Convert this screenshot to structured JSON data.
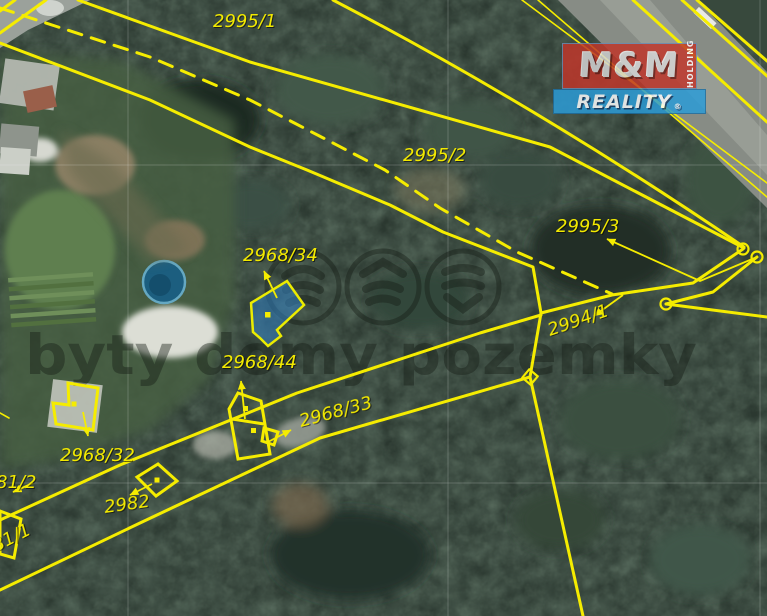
{
  "map": {
    "watermark": {
      "text": "byty domy pozemky"
    },
    "logo": {
      "mm": "M&M",
      "holding": "HOLDING",
      "reality": "REALITY",
      "registered": "®"
    },
    "colors": {
      "line": "#f5ec00",
      "label": "#f2e900",
      "watermark": "rgba(22,28,22,0.42)",
      "highlight_fill": "#2f80c2",
      "logo_red": "#c0362a",
      "logo_blue": "#2b9cd8"
    },
    "parcel_labels": [
      {
        "text": "2995/1",
        "x": 213,
        "y": 27,
        "rot": 0
      },
      {
        "text": "2995/2",
        "x": 403,
        "y": 161,
        "rot": 0
      },
      {
        "text": "2995/3",
        "x": 556,
        "y": 232,
        "rot": 0
      },
      {
        "text": "2994/1",
        "x": 550,
        "y": 336,
        "rot": -19
      },
      {
        "text": "2968/34",
        "x": 243,
        "y": 261,
        "rot": 0
      },
      {
        "text": "2968/44",
        "x": 222,
        "y": 368,
        "rot": 0
      },
      {
        "text": "2968/33",
        "x": 301,
        "y": 427,
        "rot": -15
      },
      {
        "text": "2968/32",
        "x": 60,
        "y": 461,
        "rot": 0
      },
      {
        "text": "2982",
        "x": 105,
        "y": 513,
        "rot": -8
      },
      {
        "text": "81/2",
        "x": -4,
        "y": 488,
        "rot": 0
      },
      {
        "text": "81/1",
        "x": -4,
        "y": 552,
        "rot": -27
      }
    ]
  }
}
